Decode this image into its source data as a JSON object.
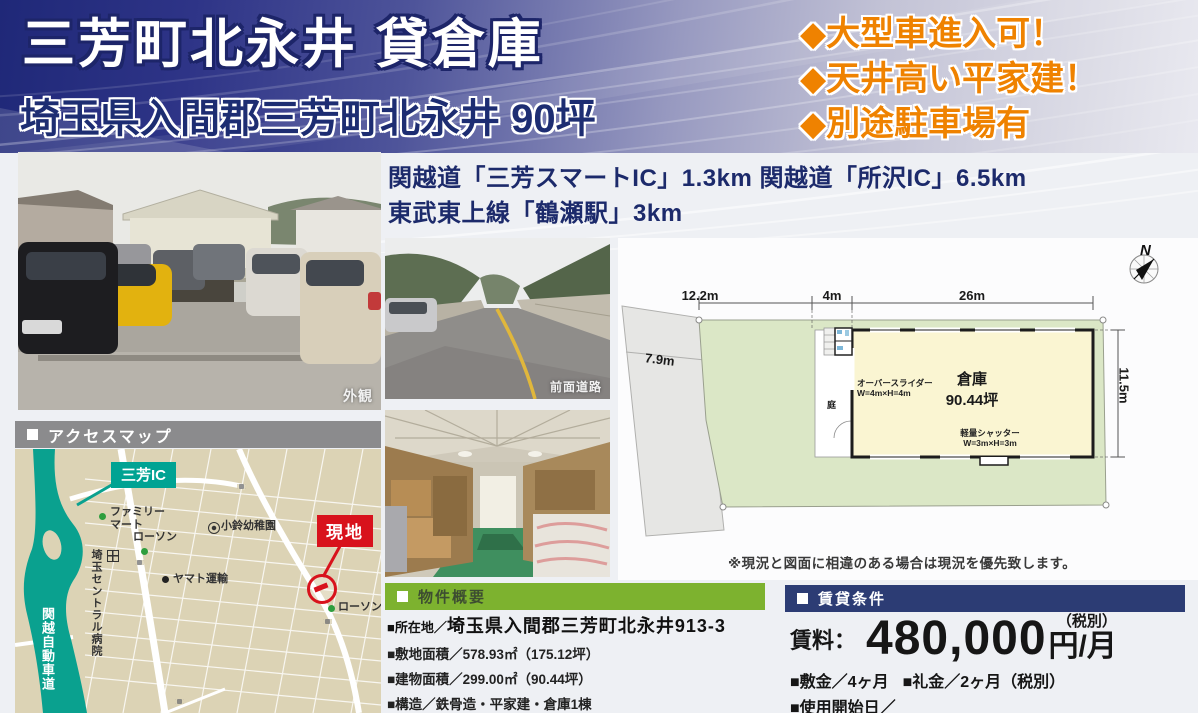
{
  "header": {
    "title": "三芳町北永井 貸倉庫",
    "subtitle": "埼玉県入間郡三芳町北永井 90坪",
    "features": [
      "◆大型車進入可！",
      "◆天井高い平家建！",
      "◆別途駐車場有"
    ]
  },
  "access_text": {
    "line1": "関越道「三芳スマートIC」1.3km 関越道「所沢IC」6.5km",
    "line2": "東武東上線「鶴瀬駅」3km"
  },
  "photos": {
    "exterior_caption": "外観",
    "road_caption": "前面道路"
  },
  "map": {
    "header": "アクセスマップ",
    "ic_badge": "三芳IC",
    "labels": {
      "familymart_line1": "ファミリー",
      "familymart_line2": "マート",
      "lawson1": "ローソン",
      "hospital": "埼玉セントラル病院",
      "yamato": "ヤマト運輸",
      "kindergarten": "小鈴幼稚園",
      "site_badge": "現地",
      "lawson2": "ローソン",
      "expressway": "関越自動車道"
    }
  },
  "plan": {
    "compass_n": "N",
    "dims": {
      "top_left": "12.2m",
      "top_mid": "4m",
      "top_right": "26m",
      "parcel": "7.9m",
      "right": "11.5m"
    },
    "labels": {
      "warehouse_name": "倉庫",
      "warehouse_area": "90.44坪",
      "overslider_line1": "オーバースライダー",
      "overslider_line2": "W=4m×H=4m",
      "shutter_line1": "軽量シャッター",
      "shutter_line2": "W=3m×H=3m",
      "garden": "庭"
    },
    "note": "※現況と図面に相違のある場合は現況を優先致します。"
  },
  "property": {
    "header": "物件概要",
    "location_label": "■所在地／",
    "location_value": "埼玉県入間郡三芳町北永井913-3",
    "items": [
      "■敷地面積／578.93㎡（175.12坪）",
      "■建物面積／299.00㎡（90.44坪）",
      "■構造／鉄骨造・平家建・倉庫1棟",
      "■用途地域／市街化調整区域"
    ]
  },
  "rent": {
    "header": "賃貸条件",
    "label": "賃料：",
    "amount": "480,000",
    "unit": "円/月",
    "tax_note": "（税別）",
    "deposit": "■敷金／4ヶ月",
    "key_money": "■礼金／2ヶ月（税別）",
    "start_date": "■使用開始日／"
  },
  "colors": {
    "header_navy": "#1f2878",
    "accent_orange": "#ef8200",
    "text_navy": "#1c2a6b",
    "green_bar": "#7db22f",
    "navy_bar": "#2c3c74",
    "map_teal": "#00a393",
    "site_red": "#d8121c",
    "land_green": "#dbe7c6",
    "building_yellow": "#faf5d2"
  }
}
